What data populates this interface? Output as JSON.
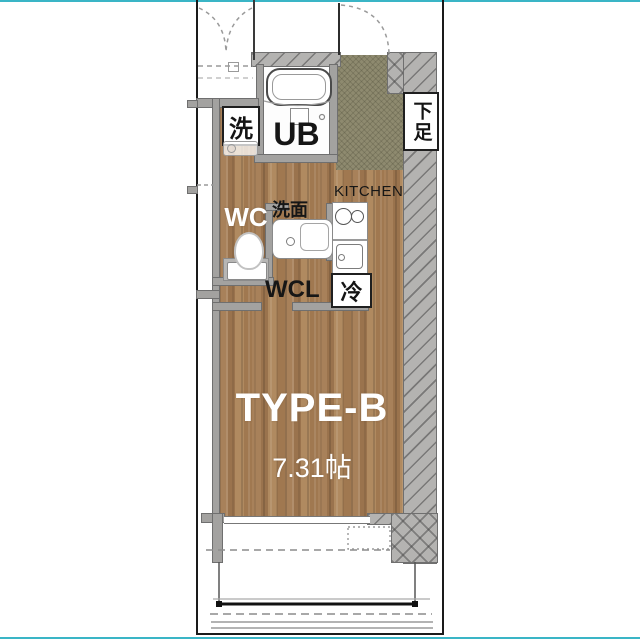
{
  "floor_plan": {
    "title": "TYPE-B",
    "area": "7.31帖",
    "labels": {
      "unit_bath": "UB",
      "washing_machine": "洗",
      "shoe_cabinet": "下足",
      "toilet": "WC",
      "washstand": "洗面",
      "kitchen": "KITCHEN",
      "refrigerator": "冷",
      "walk_in_closet": "WCL"
    },
    "colors": {
      "wood_floor": "#a8815a",
      "entrance_floor": "#8e8a6f",
      "wall_gray": "#b4b3b1",
      "accent_border": "#3ab5c6",
      "room_title_text": "#ffffff",
      "label_text": "#161616"
    }
  }
}
